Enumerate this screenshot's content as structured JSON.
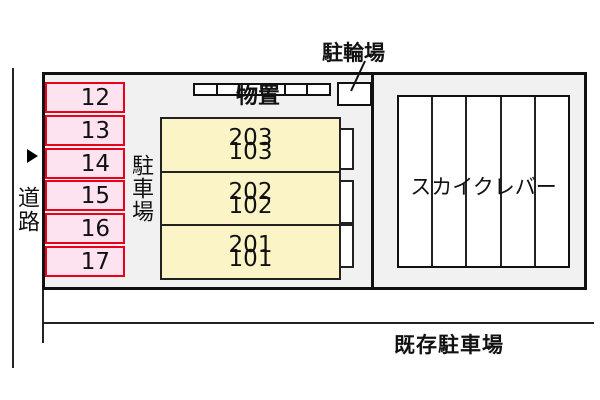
{
  "diagram": {
    "road_label": "道路",
    "parking_area_label": "駐車場",
    "storage_label": "物置",
    "bicycle_parking_label": "駐輪場",
    "building_name": "スカイクレバー",
    "existing_parking_label": "既存駐車場",
    "parking_spots": [
      "12",
      "13",
      "14",
      "15",
      "16",
      "17"
    ],
    "building_units": [
      {
        "upper": "203",
        "lower": "103"
      },
      {
        "upper": "202",
        "lower": "102"
      },
      {
        "upper": "201",
        "lower": "101"
      }
    ],
    "counts": {
      "parking_spot_count": 6,
      "storage_cell_count": 6,
      "sky_column_count": 5
    },
    "colors": {
      "site_fill": "#f1f1f1",
      "parking_spot_fill": "#fce3ef",
      "parking_spot_border": "#e8001c",
      "building_fill": "#faf4c6",
      "line_color": "#111111"
    }
  }
}
